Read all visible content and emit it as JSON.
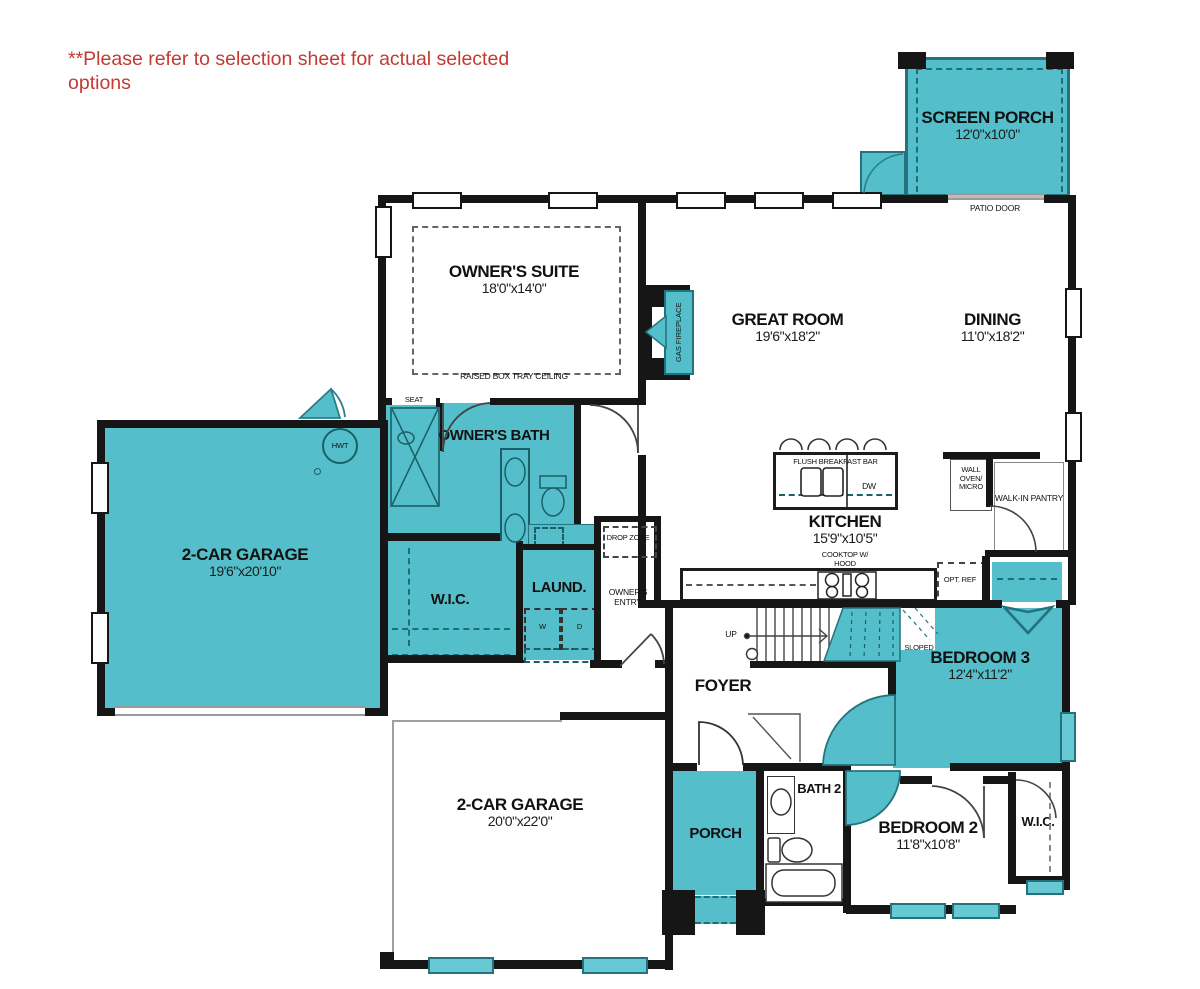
{
  "disclaimer": "**Please refer to selection sheet for actual selected options",
  "colors": {
    "teal": "#54bfca",
    "teal_dark": "#23727c",
    "wall": "#161616",
    "red": "#c23b33"
  },
  "rooms": {
    "screen_porch": {
      "name": "SCREEN PORCH",
      "dims": "12'0\"x10'0\""
    },
    "owners_suite": {
      "name": "OWNER'S SUITE",
      "dims": "18'0\"x14'0\"",
      "note": "RAISED BOX TRAY CEILING"
    },
    "great_room": {
      "name": "GREAT ROOM",
      "dims": "19'6\"x18'2\""
    },
    "dining": {
      "name": "DINING",
      "dims": "11'0\"x18'2\""
    },
    "owners_bath": {
      "name": "OWNER'S BATH"
    },
    "wic_owner": {
      "name": "W.I.C."
    },
    "laundry": {
      "name": "LAUND."
    },
    "drop_zone": {
      "name": "DROP ZONE"
    },
    "owners_entry": {
      "name": "OWNER'S ENTRY"
    },
    "garage_upper": {
      "name": "2-CAR GARAGE",
      "dims": "19'6\"x20'10\""
    },
    "kitchen": {
      "name": "KITCHEN",
      "dims": "15'9\"x10'5\""
    },
    "pantry": {
      "name": "WALK-IN PANTRY"
    },
    "foyer": {
      "name": "FOYER"
    },
    "bedroom3": {
      "name": "BEDROOM 3",
      "dims": "12'4\"x11'2\""
    },
    "garage_lower": {
      "name": "2-CAR GARAGE",
      "dims": "20'0\"x22'0\""
    },
    "porch": {
      "name": "PORCH"
    },
    "bath2": {
      "name": "BATH 2"
    },
    "bedroom2": {
      "name": "BEDROOM 2",
      "dims": "11'8\"x10'8\""
    },
    "wic2": {
      "name": "W.I.C."
    }
  },
  "labels": {
    "patio_door": "PATIO DOOR",
    "gas_fireplace": "GAS FIREPLACE",
    "seat": "SEAT",
    "hwt": "HWT",
    "flush_bar": "FLUSH BREAKFAST BAR",
    "dw": "DW",
    "cooktop": "COOKTOP W/ HOOD",
    "opt_ref": "OPT. REF",
    "wall_oven": "WALL OVEN/ MICRO",
    "washer": "W",
    "dryer": "D",
    "up": "UP",
    "low_headroom": "LOW HEADROOM STORAGE",
    "sloped_ceiling": "SLOPED CEILING"
  }
}
